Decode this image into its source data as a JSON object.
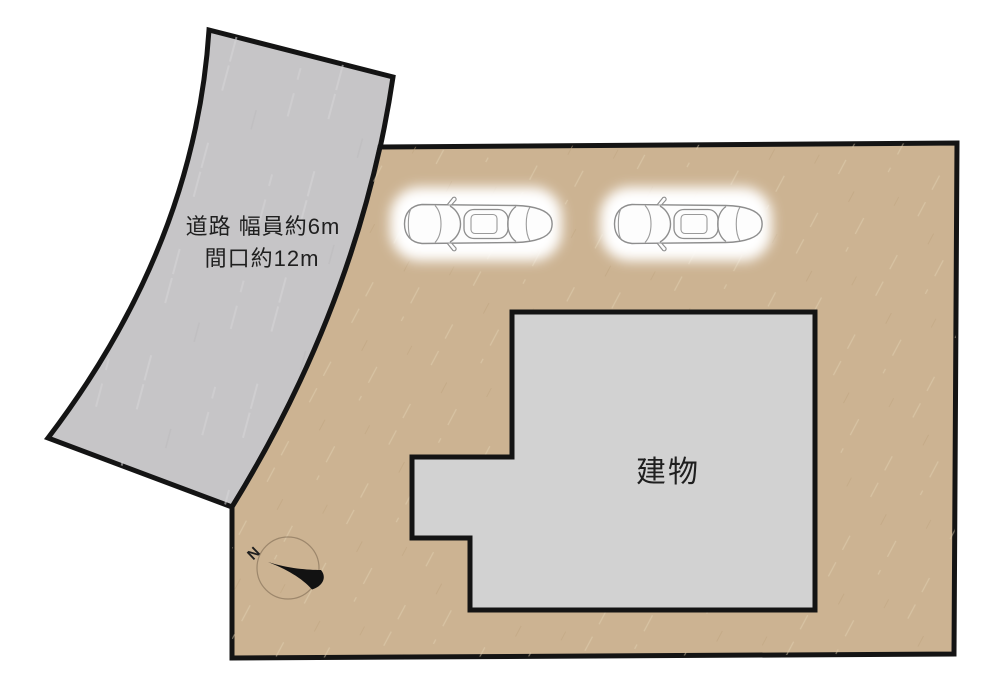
{
  "title": "property-site-plan",
  "colors": {
    "background": "#ffffff",
    "road_fill": "#c6c5c7",
    "parcel_fill": "#ccb392",
    "building_fill": "#d2d2d2",
    "outline": "#141414",
    "car_line": "#8e8e8e",
    "car_body": "#fdfdfd",
    "text": "#1f1f1f"
  },
  "road": {
    "label_line1": "道路 幅員約6m",
    "label_line2": "間口約12m"
  },
  "building": {
    "label": "建物"
  },
  "compass": {
    "north_label": "N"
  },
  "icons": {
    "car": "top-view-sedan-icon",
    "compass": "north-arrow-icon"
  },
  "cars_count": 2
}
